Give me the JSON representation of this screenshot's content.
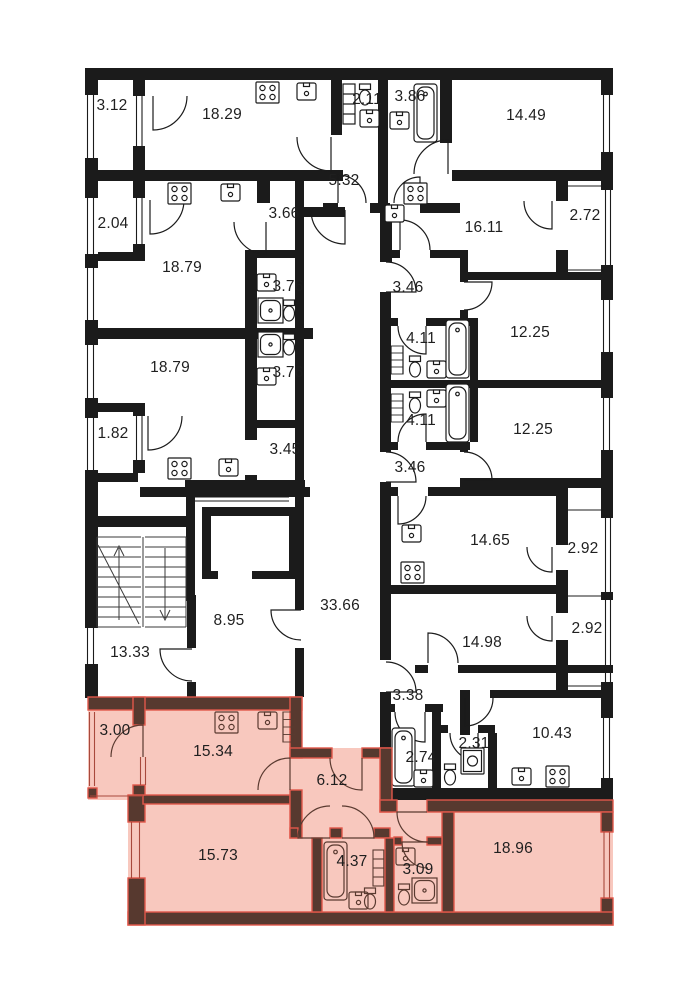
{
  "colors": {
    "wall": "#1b1b1b",
    "paper": "#ffffff",
    "highlight_fill": "#f8c8be",
    "highlight_wall": "#57392f",
    "highlight_accent": "#e2574a"
  },
  "labels": [
    {
      "room": "balcony-3-12",
      "area": "3.12",
      "highlighted": false
    },
    {
      "room": "room-18-29",
      "area": "18.29",
      "highlighted": false
    },
    {
      "room": "wc-2-11",
      "area": "2.11",
      "highlighted": false
    },
    {
      "room": "bath-3-86",
      "area": "3.86",
      "highlighted": false
    },
    {
      "room": "room-14-49",
      "area": "14.49",
      "highlighted": false
    },
    {
      "room": "hall-5-32",
      "area": "5.32",
      "highlighted": false
    },
    {
      "room": "balcony-2-04",
      "area": "2.04",
      "highlighted": false
    },
    {
      "room": "hall-3-66",
      "area": "3.66",
      "highlighted": false
    },
    {
      "room": "room-16-11",
      "area": "16.11",
      "highlighted": false
    },
    {
      "room": "balcony-2-72",
      "area": "2.72",
      "highlighted": false
    },
    {
      "room": "room-18-79-a",
      "area": "18.79",
      "highlighted": false
    },
    {
      "room": "bath-3-76-a",
      "area": "3.76",
      "highlighted": false
    },
    {
      "room": "hall-3-46-a",
      "area": "3.46",
      "highlighted": false
    },
    {
      "room": "room-12-25-a",
      "area": "12.25",
      "highlighted": false
    },
    {
      "room": "bath-4-11-a",
      "area": "4.11",
      "highlighted": false
    },
    {
      "room": "room-18-79-b",
      "area": "18.79",
      "highlighted": false
    },
    {
      "room": "bath-3-76-b",
      "area": "3.76",
      "highlighted": false
    },
    {
      "room": "bath-4-11-b",
      "area": "4.11",
      "highlighted": false
    },
    {
      "room": "room-12-25-b",
      "area": "12.25",
      "highlighted": false
    },
    {
      "room": "balcony-1-82",
      "area": "1.82",
      "highlighted": false
    },
    {
      "room": "hall-3-45",
      "area": "3.45",
      "highlighted": false
    },
    {
      "room": "hall-3-46-b",
      "area": "3.46",
      "highlighted": false
    },
    {
      "room": "room-14-65",
      "area": "14.65",
      "highlighted": false
    },
    {
      "room": "balcony-2-92-a",
      "area": "2.92",
      "highlighted": false
    },
    {
      "room": "lift-lobby-8-95",
      "area": "8.95",
      "highlighted": false
    },
    {
      "room": "corridor-33-66",
      "area": "33.66",
      "highlighted": false
    },
    {
      "room": "lobby-13-33",
      "area": "13.33",
      "highlighted": false
    },
    {
      "room": "room-14-98",
      "area": "14.98",
      "highlighted": false
    },
    {
      "room": "balcony-2-92-b",
      "area": "2.92",
      "highlighted": false
    },
    {
      "room": "hall-3-38",
      "area": "3.38",
      "highlighted": false
    },
    {
      "room": "room-10-43",
      "area": "10.43",
      "highlighted": false
    },
    {
      "room": "hl-balcony-3-00",
      "area": "3.00",
      "highlighted": true
    },
    {
      "room": "hl-kitchen-15-34",
      "area": "15.34",
      "highlighted": true
    },
    {
      "room": "hl-hall-6-12",
      "area": "6.12",
      "highlighted": true
    },
    {
      "room": "wc-2-74",
      "area": "2.74",
      "highlighted": false
    },
    {
      "room": "wc-2-31",
      "area": "2.31",
      "highlighted": false
    },
    {
      "room": "hl-room-15-73",
      "area": "15.73",
      "highlighted": true
    },
    {
      "room": "hl-bath-4-37",
      "area": "4.37",
      "highlighted": true
    },
    {
      "room": "hl-shower-3-09",
      "area": "3.09",
      "highlighted": true
    },
    {
      "room": "hl-room-18-96",
      "area": "18.96",
      "highlighted": true
    }
  ]
}
